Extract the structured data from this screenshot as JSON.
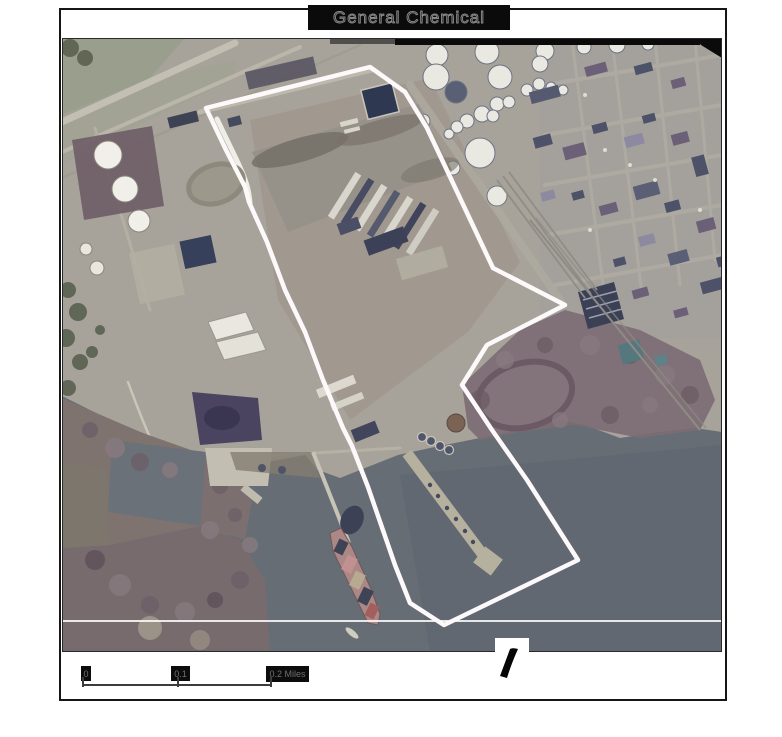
{
  "title": "General Chemical",
  "scale_bar": {
    "labels": [
      "0",
      "0.1",
      "0.2 Miles"
    ]
  },
  "colors": {
    "boundary": "#fdf9fb",
    "water": "#666d75",
    "land": "#a7a39a"
  }
}
